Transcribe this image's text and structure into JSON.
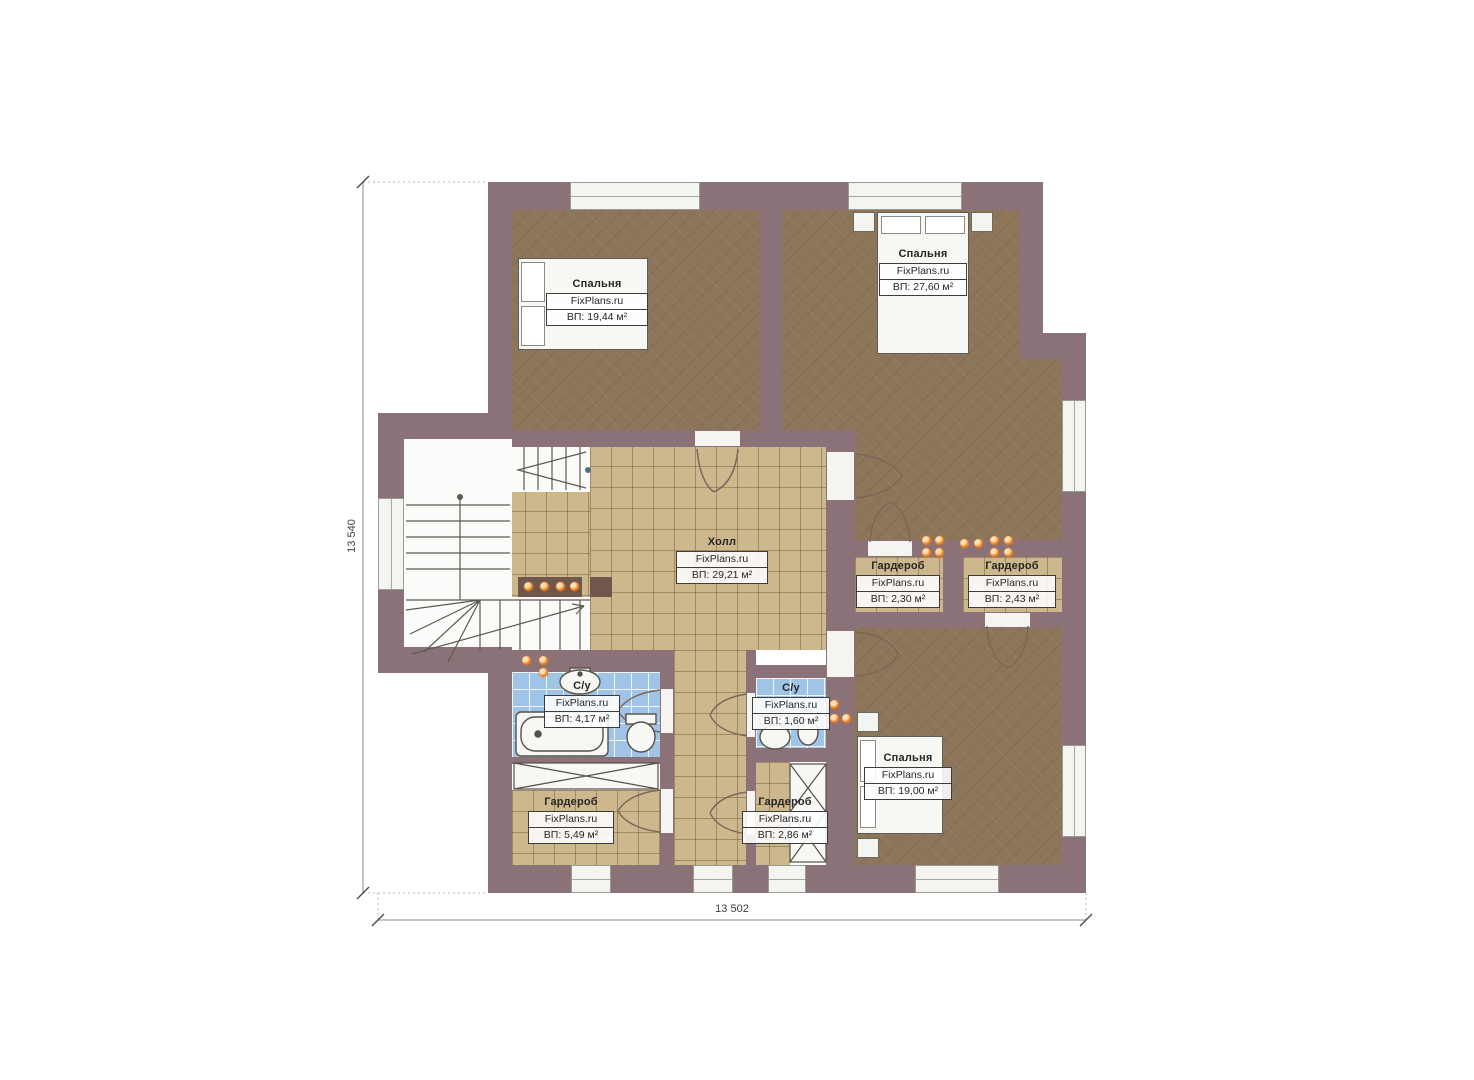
{
  "plan": {
    "brand": "FixPlans.ru",
    "dimensions": {
      "left": "13 540",
      "bottom": "13 502"
    },
    "rooms": [
      {
        "id": "bedroom-top-left",
        "name": "Спальня",
        "area": "ВП: 19,44 м²"
      },
      {
        "id": "bedroom-top-right",
        "name": "Спальня",
        "area": "ВП: 27,60 м²"
      },
      {
        "id": "hall",
        "name": "Холл",
        "area": "ВП: 29,21 м²"
      },
      {
        "id": "wardrobe-middle-left",
        "name": "Гардероб",
        "area": "ВП: 2,30 м²"
      },
      {
        "id": "wardrobe-middle-right",
        "name": "Гардероб",
        "area": "ВП: 2,43 м²"
      },
      {
        "id": "bathroom-left",
        "name": "С/у",
        "area": "ВП: 4,17 м²"
      },
      {
        "id": "bathroom-center",
        "name": "С/у",
        "area": "ВП: 1,60 м²"
      },
      {
        "id": "bedroom-bottom-right",
        "name": "Спальня",
        "area": "ВП: 19,00 м²"
      },
      {
        "id": "wardrobe-bottom-left",
        "name": "Гардероб",
        "area": "ВП: 5,49 м²"
      },
      {
        "id": "wardrobe-bottom-center",
        "name": "Гардероб",
        "area": "ВП: 2,86 м²"
      }
    ],
    "colors": {
      "wall": "#8b7278",
      "bedroom_floor": "#8c7558",
      "tile_floor": "#cdb78c",
      "bath_tile": "#a0c4e6",
      "downlight": "#ef7d1e"
    }
  }
}
